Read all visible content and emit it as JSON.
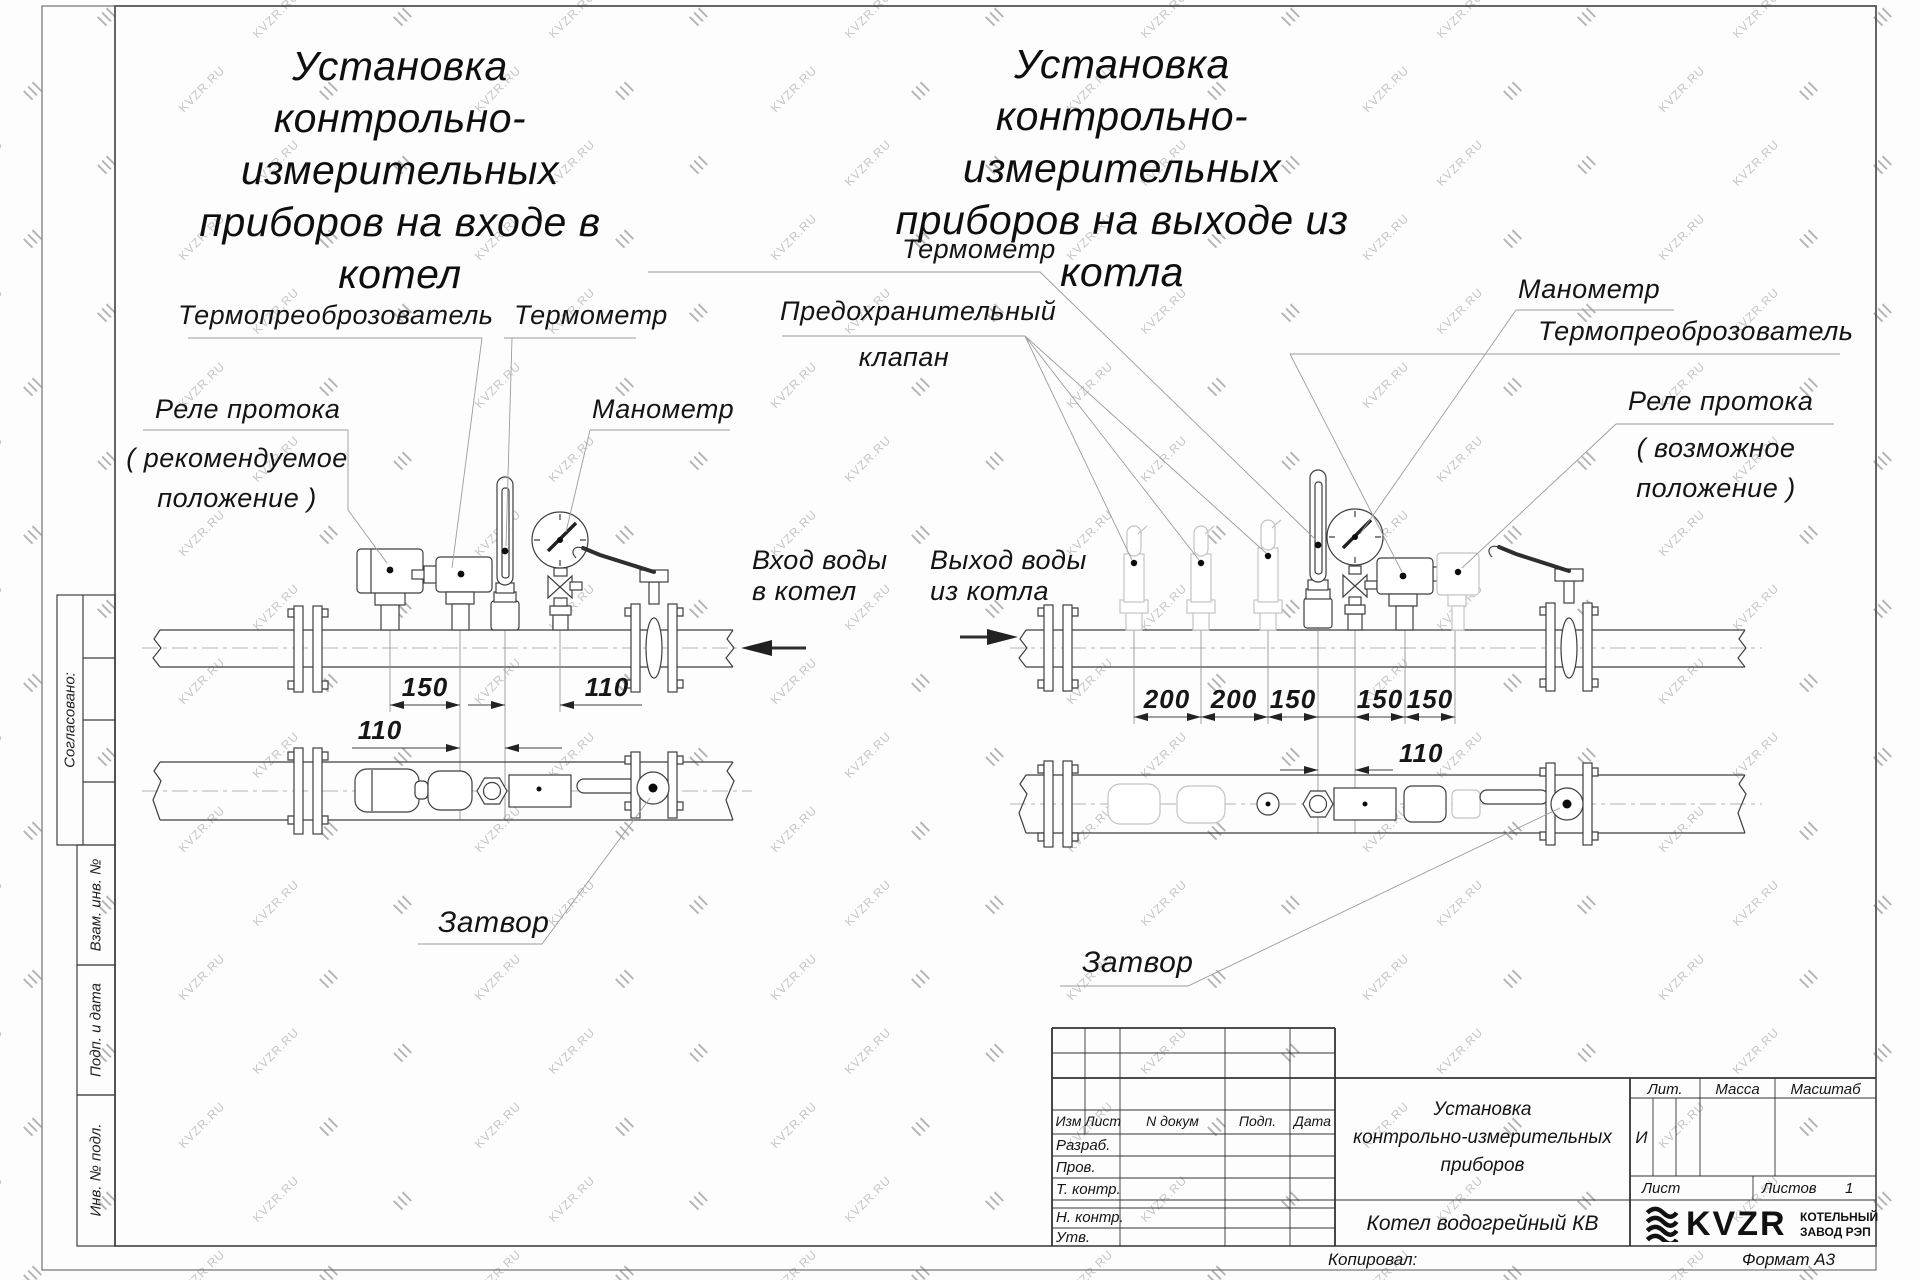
{
  "watermark": {
    "text": "KVZR.RU"
  },
  "left": {
    "title": [
      "Установка",
      "контрольно-измерительных",
      "приборов на входе в",
      "котел"
    ],
    "labels": {
      "transducer": "Термопреоброзователь",
      "thermometer": "Термометр",
      "flow_relay": "Реле протока",
      "flow_relay_note": [
        "( рекомендуемое",
        "положение )"
      ],
      "manometer": "Манометр",
      "valve": "Затвор"
    },
    "flow": [
      "Вход воды",
      "в котел"
    ],
    "dims": {
      "a": "150",
      "b": "110",
      "c": "110"
    }
  },
  "right": {
    "title": [
      "Установка",
      "контрольно-измерительных",
      "приборов на выходе из",
      "котла"
    ],
    "labels": {
      "thermometer": "Термометр",
      "safety_valve": [
        "Предохранительный",
        "клапан"
      ],
      "manometer": "Манометр",
      "transducer": "Термопреоброзователь",
      "flow_relay": "Реле протока",
      "flow_relay_note": [
        "( возможное",
        "положение )"
      ],
      "valve": "Затвор"
    },
    "flow": [
      "Выход воды",
      "из котла"
    ],
    "dims": {
      "a": "200",
      "b": "200",
      "c": "150",
      "d": "150",
      "e": "150",
      "f": "110"
    }
  },
  "sidebar": {
    "agreed": "Согласовано:",
    "vzam": "Взам. инв. №",
    "podp": "Подп. и дата",
    "inv": "Инв. № подл."
  },
  "stamp": {
    "cols": {
      "izm": "Изм",
      "list": "Лист",
      "doc": "N докум",
      "podp": "Подп.",
      "data": "Дата"
    },
    "rows": {
      "razrab": "Разраб.",
      "prov": "Пров.",
      "tkontr": "Т. контр.",
      "nkontr": "Н. контр.",
      "utv": "Утв."
    },
    "title": [
      "Установка",
      "контрольно-измерительных",
      "приборов"
    ],
    "product": "Котел водогрейный КВ",
    "lit_label": "Лит.",
    "lit_value": "И",
    "mass_label": "Масса",
    "scale_label": "Масштаб",
    "sheet_label": "Лист",
    "sheets_label": "Листов",
    "sheets_value": "1",
    "logo": {
      "text": "KVZR",
      "sub1": "КОТЕЛЬНЫЙ",
      "sub2": "ЗАВОД РЭП"
    },
    "copied": "Копировал:",
    "format": "Формат А3"
  }
}
